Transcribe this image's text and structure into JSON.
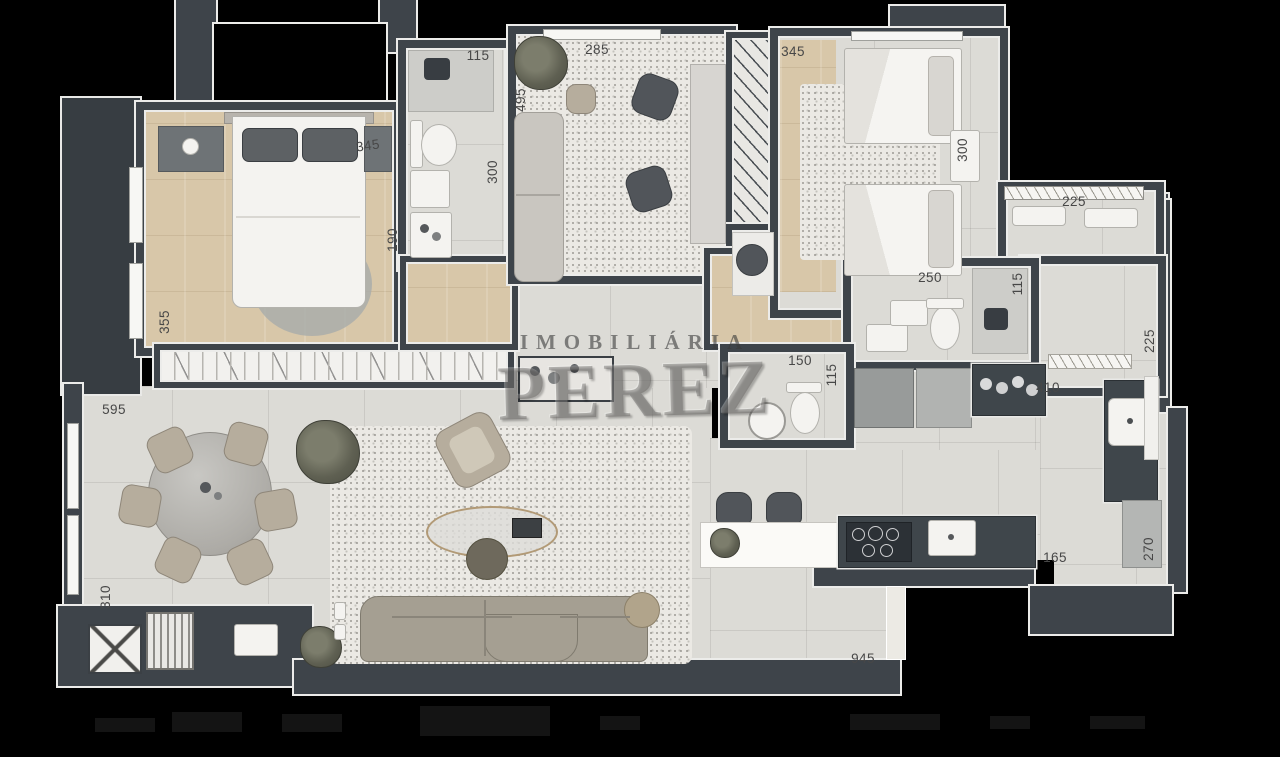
{
  "watermark": {
    "line1": "IMOBILIÁRIA",
    "line2": "PEREZ"
  },
  "dimension_labels": [
    "345",
    "190",
    "355",
    "115",
    "300",
    "285",
    "495",
    "345",
    "300",
    "225",
    "115",
    "225",
    "250",
    "150",
    "115",
    "410",
    "595",
    "310",
    "165",
    "270",
    "945"
  ],
  "colors": {
    "background": "#000000",
    "wall": "#3e444a",
    "wall_outline": "#ececea",
    "floor_tile": "#dcdbd6",
    "wood_floor": "#d8c7a9",
    "rug_speckle": "#ebe9e4",
    "label_text": "#474747",
    "watermark_text": "rgba(96,94,90,0.45)"
  }
}
